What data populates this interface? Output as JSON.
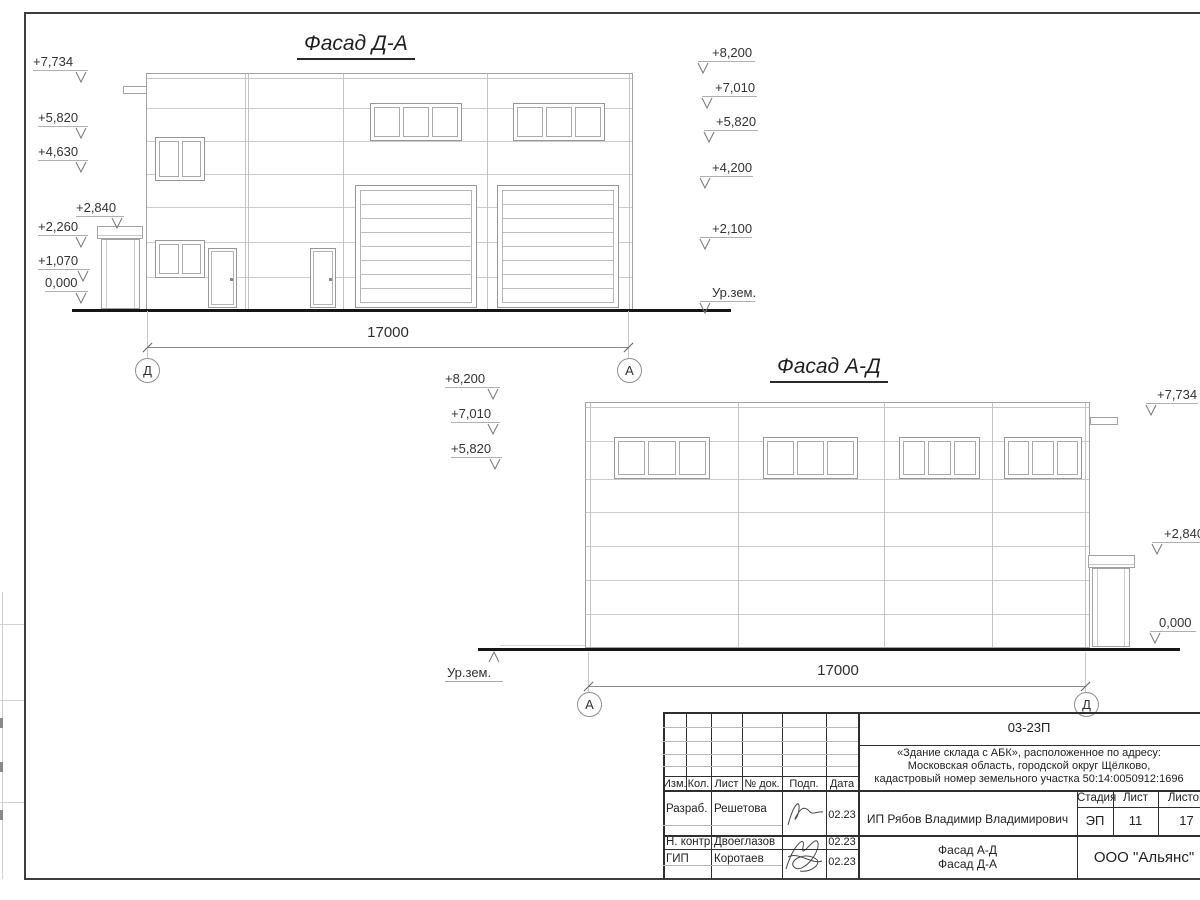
{
  "facade1": {
    "title": "Фасад Д-А",
    "dimension": "17000",
    "axis_left": "Д",
    "axis_right": "А",
    "elevations_left": [
      "+7,734",
      "+5,820",
      "+4,630",
      "+2,840",
      "+2,260",
      "+1,070",
      "0,000"
    ],
    "elevations_right": [
      "+8,200",
      "+7,010",
      "+5,820",
      "+4,200",
      "+2,100",
      "Ур.зем."
    ]
  },
  "facade2": {
    "title": "Фасад А-Д",
    "dimension": "17000",
    "axis_left": "А",
    "axis_right": "Д",
    "elevations_left": [
      "+8,200",
      "+7,010",
      "+5,820"
    ],
    "elevations_right": [
      "+7,734",
      "+2,840",
      "0,000"
    ],
    "ground_label": "Ур.зем."
  },
  "sheet": {
    "code": "03-23П",
    "address_line1": "«Здание склада с АБК», расположенное по адресу:",
    "address_line2": "Московская область, городской округ Щёлково,",
    "address_line3": "кадастровый номер земельного участка 50:14:0050912:1696",
    "client": "ИП Рябов Владимир Владимирович",
    "doc_title_line1": "Фасад А-Д",
    "doc_title_line2": "Фасад Д-А",
    "organization": "ООО \"Альянс\"",
    "stage_label": "Стадия",
    "sheet_label": "Лист",
    "sheets_label": "Листов",
    "stage_value": "ЭП",
    "sheet_value": "11",
    "sheets_value": "17",
    "columns": [
      "Изм.",
      "Кол.",
      "Лист",
      "№ док.",
      "Подп.",
      "Дата"
    ],
    "roles": [
      {
        "role": "Разраб.",
        "name": "Решетова",
        "date": "02.23"
      },
      {
        "role": "Н. контр.",
        "name": "Двоеглазов",
        "date": "02.23"
      },
      {
        "role": "ГИП",
        "name": "Коротаев",
        "date": "02.23"
      }
    ]
  }
}
